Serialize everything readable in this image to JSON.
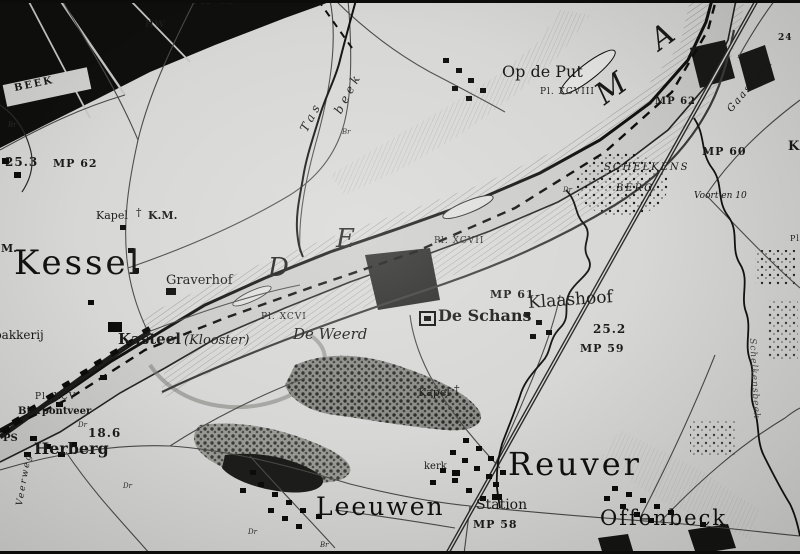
{
  "map": {
    "colors": {
      "paper": "#d7d7d5",
      "ink": "#141412",
      "water": "#cbcbc9",
      "woods": "#151513",
      "hatch": "#90908e"
    },
    "towns": {
      "kessel": "Kessel",
      "reuver": "Reuver",
      "leeuwen": "Leeuwen",
      "offenbeck": "Offenbeck"
    },
    "places": {
      "op_de_put": "Op de Put",
      "de_schans": "De Schans",
      "de_weerd": "De Weerd",
      "klaashoof": "Klaashoof",
      "graverhof": "Graverhof",
      "kasteel": "Kasteel",
      "klooster": "(Klooster)",
      "herberg": "Herberg",
      "bierpontveer": "Bierpontveer",
      "bakkerij": "bakkerij",
      "station": "Station",
      "kerk": "kerk",
      "kapel": "Kapel",
      "km": "K.M.",
      "schelkens": "SCHELKENS",
      "berg": "BERG",
      "voort_en": "Voort en 10",
      "beek_caps": "BEEK",
      "veerweg": "Veerweg",
      "ps": "PS",
      "k_edge": "K",
      "m_edge": "M."
    },
    "river_letters": {
      "d": "D",
      "e": "E",
      "m": "M",
      "a": "A"
    },
    "waters": {
      "tas": "Tas",
      "beek": "beek",
      "gaasbeek": "Gaasbeek",
      "schelkensbeek": "Schelkensbeek"
    },
    "markers": {
      "mp63": "MP 63",
      "mp62_w": "MP 62",
      "mp62_e": "MP 62",
      "mp61": "MP 61",
      "mp60": "MP 60",
      "mp59": "MP 59",
      "mp58": "MP 58",
      "hw": "HW",
      "h25_3": "25.3",
      "h25_2": "25.2",
      "h18_6": "18.6",
      "h24": "24",
      "pl_xcv": "Pl. XCV",
      "pl_xcvi": "Pl. XCVI",
      "pl_xcvii": "Pl. XCVII",
      "pl_xcviii": "Pl. XCVIII",
      "pl_edge": "Pl.",
      "br": "Br",
      "dr": "Dr",
      "cross": "†"
    }
  }
}
